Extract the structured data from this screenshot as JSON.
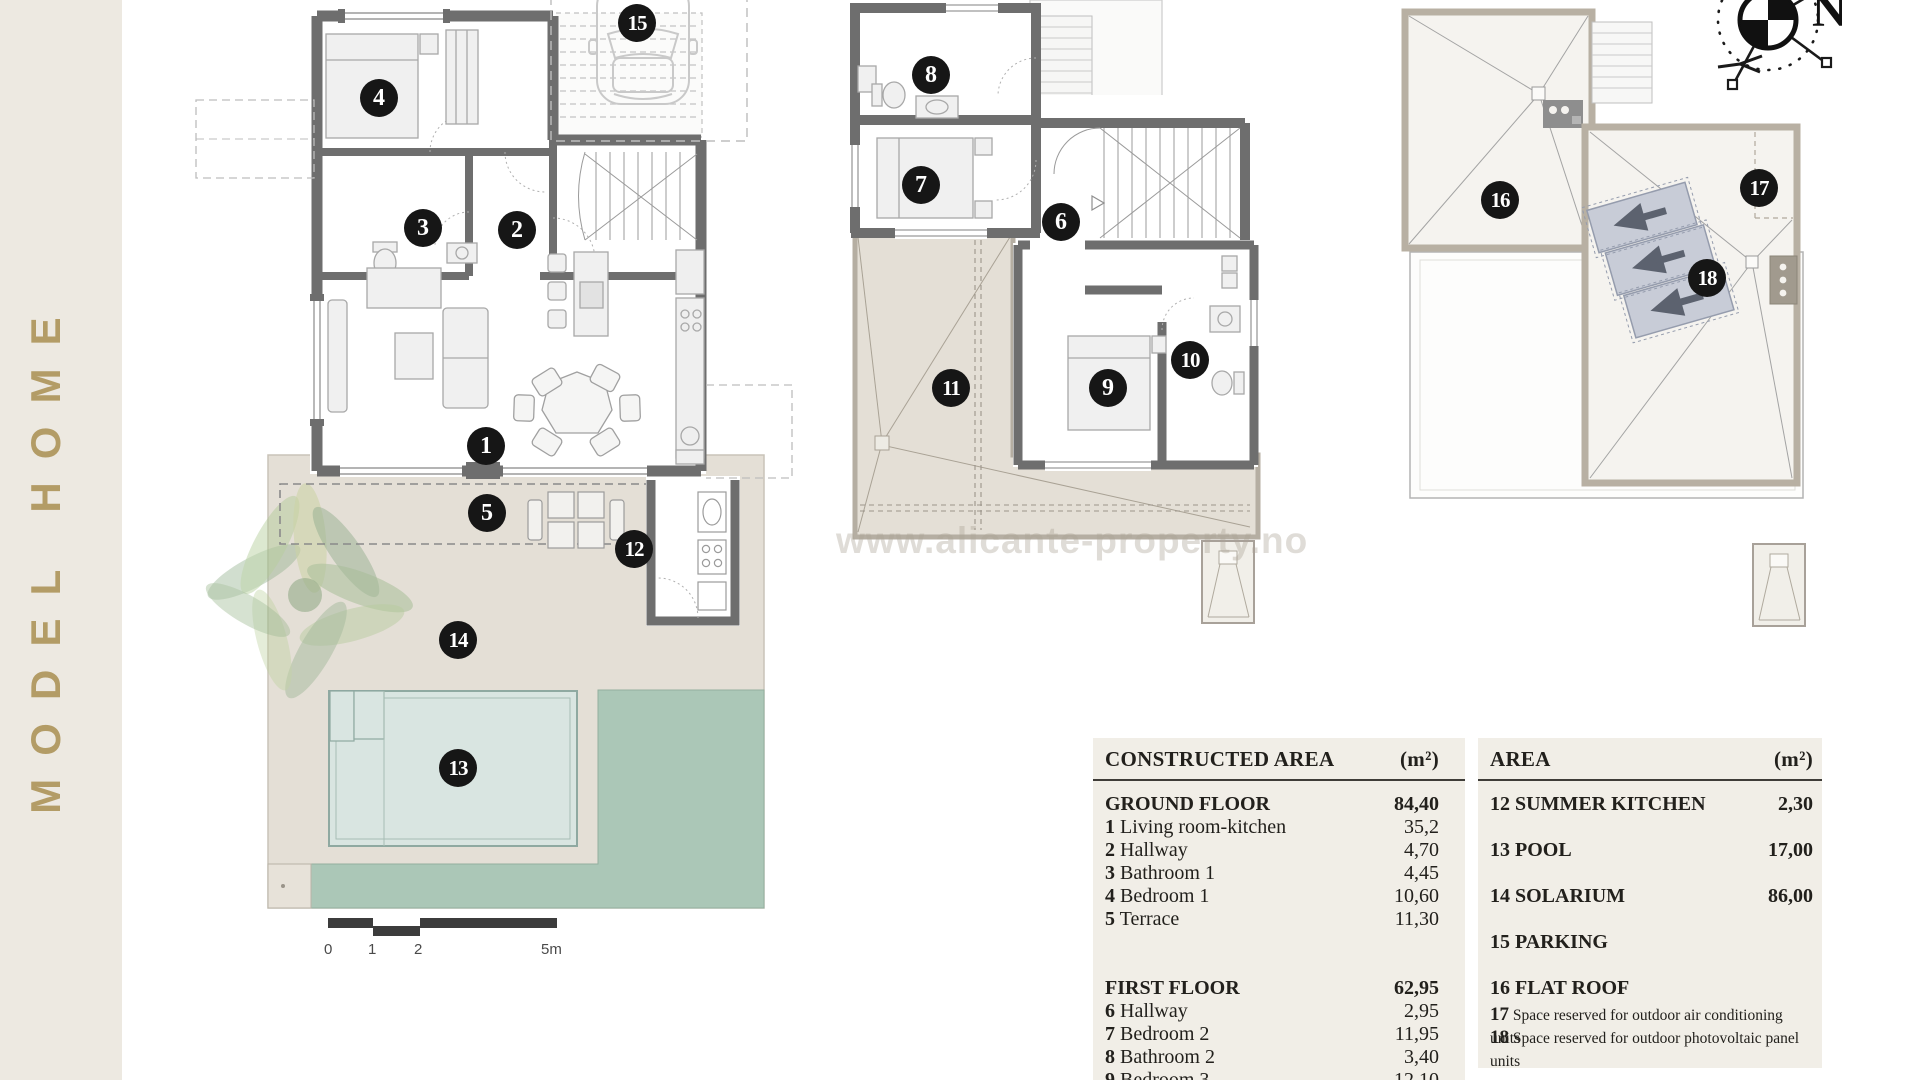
{
  "sidebar": {
    "vertical_text": "MODEL HOME"
  },
  "watermark": {
    "text": "www.alicante-property.no"
  },
  "compass": {
    "north": "N"
  },
  "scale": {
    "labels": [
      "0",
      "1",
      "2",
      "5m"
    ]
  },
  "plans": {
    "ground_floor_markers": [
      {
        "num": "1",
        "x": 486,
        "y": 446
      },
      {
        "num": "2",
        "x": 517,
        "y": 230
      },
      {
        "num": "3",
        "x": 423,
        "y": 228
      },
      {
        "num": "4",
        "x": 379,
        "y": 98
      },
      {
        "num": "5",
        "x": 487,
        "y": 513
      },
      {
        "num": "12",
        "x": 634,
        "y": 549
      },
      {
        "num": "13",
        "x": 458,
        "y": 768
      },
      {
        "num": "14",
        "x": 458,
        "y": 640
      },
      {
        "num": "15",
        "x": 637,
        "y": 23
      }
    ],
    "first_floor_markers": [
      {
        "num": "6",
        "x": 1061,
        "y": 222
      },
      {
        "num": "7",
        "x": 921,
        "y": 185
      },
      {
        "num": "8",
        "x": 931,
        "y": 75
      },
      {
        "num": "9",
        "x": 1108,
        "y": 388
      },
      {
        "num": "10",
        "x": 1190,
        "y": 360
      },
      {
        "num": "11",
        "x": 951,
        "y": 388
      }
    ],
    "roof_markers": [
      {
        "num": "16",
        "x": 1500,
        "y": 200
      },
      {
        "num": "17",
        "x": 1759,
        "y": 188
      },
      {
        "num": "18",
        "x": 1707,
        "y": 278
      }
    ]
  },
  "tables": {
    "constructed": {
      "title": "CONSTRUCTED AREA",
      "unit": "(m²)",
      "sections": [
        {
          "label": "GROUND FLOOR",
          "value": "84,40",
          "rows": [
            {
              "num": "1",
              "label": "Living room-kitchen",
              "value": "35,2"
            },
            {
              "num": "2",
              "label": "Hallway",
              "value": "4,70"
            },
            {
              "num": "3",
              "label": "Bathroom 1",
              "value": "4,45"
            },
            {
              "num": "4",
              "label": "Bedroom 1",
              "value": "10,60"
            },
            {
              "num": "5",
              "label": "Terrace",
              "value": "11,30"
            }
          ]
        },
        {
          "label": "FIRST FLOOR",
          "value": "62,95",
          "rows": [
            {
              "num": "6",
              "label": "Hallway",
              "value": "2,95"
            },
            {
              "num": "7",
              "label": "Bedroom 2",
              "value": "11,95"
            },
            {
              "num": "8",
              "label": "Bathroom 2",
              "value": "3,40"
            },
            {
              "num": "9",
              "label": "Bedroom 3",
              "value": "12,10"
            }
          ]
        }
      ]
    },
    "area": {
      "title": "AREA",
      "unit": "(m²)",
      "rows": [
        {
          "num": "12",
          "label": "SUMMER KITCHEN",
          "value": "2,30",
          "style": "bold"
        },
        {
          "num": "13",
          "label": "POOL",
          "value": "17,00",
          "style": "bold"
        },
        {
          "num": "14",
          "label": "SOLARIUM",
          "value": "86,00",
          "style": "bold"
        },
        {
          "num": "15",
          "label": "PARKING",
          "value": "",
          "style": "bold"
        },
        {
          "num": "16",
          "label": "FLAT ROOF",
          "value": "",
          "style": "bold"
        },
        {
          "num": "17",
          "label": "Space reserved for outdoor air conditioning units",
          "value": "",
          "style": "small"
        },
        {
          "num": "18",
          "label": "Space reserved for outdoor photovoltaic panel units",
          "value": "",
          "style": "small"
        }
      ]
    }
  },
  "colors": {
    "accent_gold": "#B39C66",
    "sidebar_bg": "#EDE9E1",
    "table_bg": "#F1EEE7",
    "wall": "#6E6E6E",
    "terrace": "#E4DFD6",
    "pool": "#D9E5E1",
    "grass": "#ABC7B7",
    "roof_border": "#B8B0A3",
    "solar_panel": "#C8CCD7",
    "marker": "#161616"
  }
}
